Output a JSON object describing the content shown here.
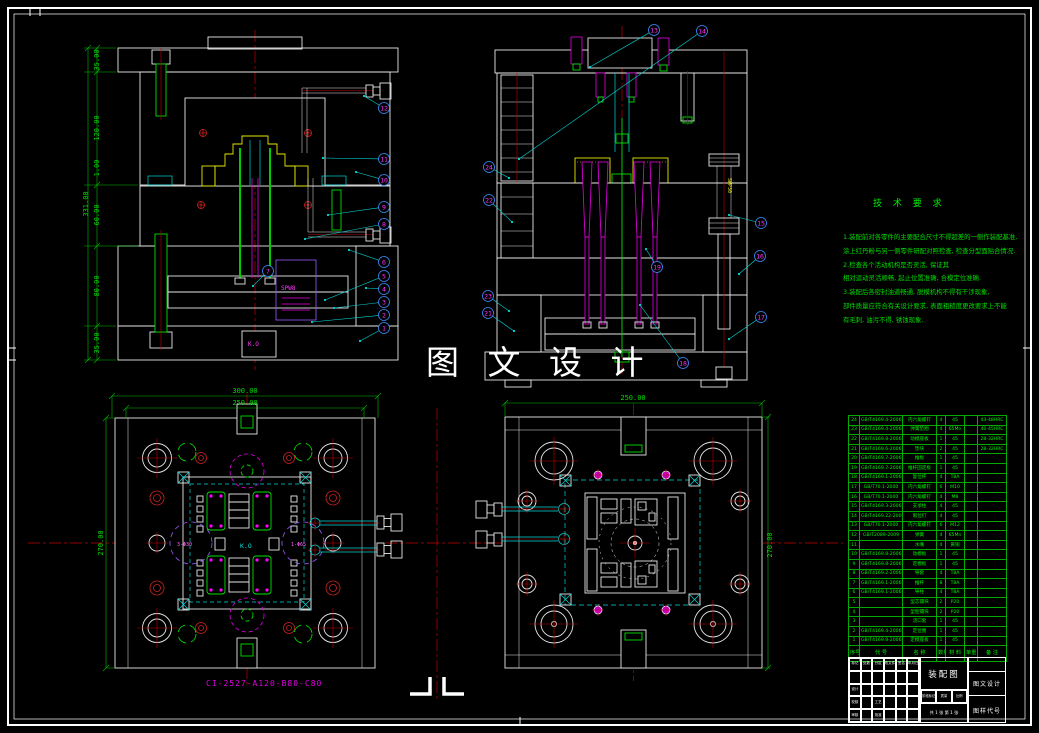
{
  "sheet": {
    "background": "#000000",
    "frame_color": "#ffffff"
  },
  "watermark": {
    "text": "图 文 设 计"
  },
  "drawing_code": {
    "text": "CI-2527-A120-B80-C80",
    "color": "#ff00ff"
  },
  "tech_requirements": {
    "title": "技 术 要 求",
    "lines": [
      "1.装配前对各零件的主要配合尺寸不得超差的一侧作装配基准,",
      "涂上红丹粉与另一侧零件研配对照检查, 检查分型面贴合情况.",
      "2.检查各个活动机构是否灵活, 保证其",
      "相对运动灵活顺畅, 起止位置准确, 合模定位准确.",
      "3.装配后各密封油道畅通, 脱模机构不得有干涉现象,",
      "部件质量应符合有关设计要求, 表面粗糙度更改要求上不能",
      "有毛刺, 油污不得, 锈蚀现象."
    ]
  },
  "labels": {
    "tl_ko": "K.O",
    "tl_spring": "SPW8",
    "tr_spring": "SWP30",
    "bl_center": "K.O",
    "bl_left_dia": "3-Φ30",
    "bl_right_dia": "1-Φ65"
  },
  "dimensions": [
    {
      "text": "35.00",
      "x": 99,
      "y": 60,
      "rot": -90
    },
    {
      "text": "120.00",
      "x": 99,
      "y": 128,
      "rot": -90
    },
    {
      "text": "1.00",
      "x": 99,
      "y": 168,
      "rot": -90
    },
    {
      "text": "60.00",
      "x": 99,
      "y": 215,
      "rot": -90
    },
    {
      "text": "80.00",
      "x": 99,
      "y": 286,
      "rot": -90
    },
    {
      "text": "35.00",
      "x": 99,
      "y": 343,
      "rot": -90
    },
    {
      "text": "331.00",
      "x": 88,
      "y": 204,
      "rot": -90
    },
    {
      "text": "300.00",
      "x": 245,
      "y": 393,
      "rot": 0
    },
    {
      "text": "250.00",
      "x": 245,
      "y": 405,
      "rot": 0
    },
    {
      "text": "270.00",
      "x": 103,
      "y": 543,
      "rot": -90
    },
    {
      "text": "250.00",
      "x": 633,
      "y": 400,
      "rot": 0
    },
    {
      "text": "270.00",
      "x": 772,
      "y": 545,
      "rot": -90
    }
  ],
  "balloons": [
    {
      "n": "12",
      "x": 384,
      "y": 108,
      "tx": 364,
      "ty": 96
    },
    {
      "n": "11",
      "x": 384,
      "y": 159,
      "tx": 323,
      "ty": 158
    },
    {
      "n": "10",
      "x": 384,
      "y": 180,
      "tx": 356,
      "ty": 172
    },
    {
      "n": "9",
      "x": 384,
      "y": 207,
      "tx": 328,
      "ty": 215
    },
    {
      "n": "8",
      "x": 384,
      "y": 224,
      "tx": 305,
      "ty": 239
    },
    {
      "n": "6",
      "x": 384,
      "y": 262,
      "tx": 349,
      "ty": 250
    },
    {
      "n": "5",
      "x": 384,
      "y": 276,
      "tx": 325,
      "ty": 300
    },
    {
      "n": "4",
      "x": 384,
      "y": 289,
      "tx": 366,
      "ty": 288
    },
    {
      "n": "3",
      "x": 384,
      "y": 302,
      "tx": 334,
      "ty": 308
    },
    {
      "n": "2",
      "x": 384,
      "y": 315,
      "tx": 312,
      "ty": 322
    },
    {
      "n": "1",
      "x": 384,
      "y": 328,
      "tx": 360,
      "ty": 341
    },
    {
      "n": "7",
      "x": 268,
      "y": 271,
      "tx": 253,
      "ty": 286
    },
    {
      "n": "13",
      "x": 654,
      "y": 30,
      "tx": 590,
      "ty": 67
    },
    {
      "n": "14",
      "x": 702,
      "y": 31,
      "tx": 519,
      "ty": 159
    },
    {
      "n": "24",
      "x": 489,
      "y": 167,
      "tx": 509,
      "ty": 178
    },
    {
      "n": "22",
      "x": 489,
      "y": 200,
      "tx": 512,
      "ty": 222
    },
    {
      "n": "23",
      "x": 488,
      "y": 296,
      "tx": 509,
      "ty": 311
    },
    {
      "n": "21",
      "x": 488,
      "y": 313,
      "tx": 514,
      "ty": 331
    },
    {
      "n": "15",
      "x": 761,
      "y": 223,
      "tx": 729,
      "ty": 215
    },
    {
      "n": "16",
      "x": 760,
      "y": 256,
      "tx": 739,
      "ty": 274
    },
    {
      "n": "17",
      "x": 761,
      "y": 317,
      "tx": 729,
      "ty": 339
    },
    {
      "n": "18",
      "x": 683,
      "y": 363,
      "tx": 640,
      "ty": 305
    },
    {
      "n": "19",
      "x": 657,
      "y": 267,
      "tx": 646,
      "ty": 249
    }
  ],
  "bom": {
    "headers": [
      "序号",
      "代  号",
      "名  称",
      "数量",
      "材  料",
      "单重",
      "备  注"
    ],
    "rows": [
      [
        "24",
        "GB/T4169.4-2006",
        "内六角螺钉",
        "4",
        "45",
        "",
        "43-48HRC"
      ],
      [
        "23",
        "GB/T4169.4-2006",
        "弹簧垫圈",
        "4",
        "65Mn",
        "",
        "40-45HRC"
      ],
      [
        "22",
        "GB/T4169.8-2006",
        "动模座板",
        "1",
        "45",
        "",
        "28-32HRC"
      ],
      [
        "21",
        "GB/T4169.6-2006",
        "垫块",
        "2",
        "45",
        "",
        "28-32HRC"
      ],
      [
        "20",
        "GB/T4169.7-2006",
        "推板",
        "1",
        "45",
        "",
        ""
      ],
      [
        "19",
        "GB/T4169.7-2006",
        "推杆固定板",
        "1",
        "45",
        "",
        ""
      ],
      [
        "18",
        "GB/T4169.1-2006",
        "复位杆",
        "4",
        "T8A",
        "",
        ""
      ],
      [
        "17",
        "GB/T70.1-2000",
        "内六角螺钉",
        "6",
        "M10",
        "",
        ""
      ],
      [
        "16",
        "GB/T70.1-2000",
        "内六角螺钉",
        "4",
        "M8",
        "",
        ""
      ],
      [
        "15",
        "GB/T4169.3-2006",
        "支承柱",
        "4",
        "45",
        "",
        ""
      ],
      [
        "14",
        "GB/T4169.22-2006",
        "限位钉",
        "4",
        "45",
        "",
        ""
      ],
      [
        "13",
        "GB/T70.1-2000",
        "内六角螺钉",
        "6",
        "M12",
        "",
        ""
      ],
      [
        "12",
        "GB/T2089-2009",
        "弹簧",
        "4",
        "65Mn",
        "",
        ""
      ],
      [
        "11",
        "",
        "水嘴",
        "4",
        "黄铜",
        "",
        ""
      ],
      [
        "10",
        "GB/T4169.8-2006",
        "动模板",
        "1",
        "45",
        "",
        ""
      ],
      [
        "9",
        "GB/T4169.8-2006",
        "定模板",
        "1",
        "45",
        "",
        ""
      ],
      [
        "8",
        "GB/T4169.2-2006",
        "导套",
        "4",
        "T8A",
        "",
        ""
      ],
      [
        "7",
        "GB/T4169.1-2006",
        "推杆",
        "8",
        "T8A",
        "",
        ""
      ],
      [
        "6",
        "GB/T4169.1-2006",
        "导柱",
        "4",
        "T8A",
        "",
        ""
      ],
      [
        "5",
        "",
        "型芯镶块",
        "2",
        "P20",
        "",
        ""
      ],
      [
        "4",
        "",
        "型腔镶块",
        "2",
        "P20",
        "",
        ""
      ],
      [
        "3",
        "",
        "浇口套",
        "1",
        "45",
        "",
        ""
      ],
      [
        "2",
        "GB/T4169.4-2006",
        "定位圈",
        "1",
        "45",
        "",
        ""
      ],
      [
        "1",
        "GB/T4169.8-2006",
        "定模座板",
        "1",
        "45",
        "",
        ""
      ]
    ]
  },
  "titleblock": {
    "drawing_name": "装配图",
    "org": "图文设计",
    "code_label": "图样代号",
    "left_rows": [
      [
        "标记",
        "处数",
        "分区",
        "更改文件号",
        "签名",
        "年月日"
      ],
      [
        "",
        "",
        "",
        "",
        "",
        ""
      ],
      [
        "设计",
        "",
        "",
        "",
        "",
        ""
      ],
      [
        "校核",
        "",
        "工艺",
        "",
        "",
        ""
      ],
      [
        "审核",
        "",
        "批准",
        "",
        "",
        ""
      ]
    ],
    "mid_cells": [
      "阶段标记",
      "质量",
      "比例"
    ],
    "sheet_info": "共 1 张 第 1 张",
    "right_cells": [
      "",
      "图文设计",
      "图样代号"
    ]
  }
}
